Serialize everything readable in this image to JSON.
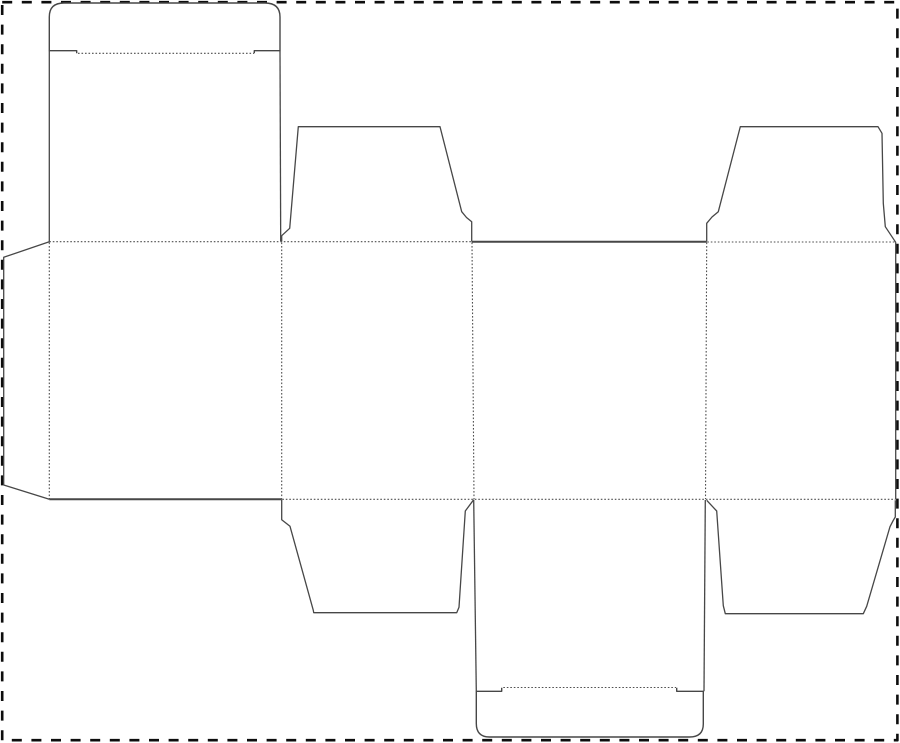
{
  "scene": {
    "width": 900,
    "height": 743,
    "background": "#ffffff",
    "description": "Die-cut folding box template (dieline) with solid cut lines and dotted fold lines inside a black dashed selection border"
  },
  "styles": {
    "cut_color": "#474747",
    "cut_width": 1.4,
    "fold_color": "#4f4f4f",
    "fold_width": 1.1,
    "fold_dash": "1.6 1.9",
    "border_color": "#0d0d0d",
    "border_width": 2.6,
    "border_dash": "10 9.6"
  },
  "border": {
    "x": 2.2,
    "y": 2.2,
    "width": 895.2,
    "height": 738
  },
  "dieline": {
    "cut_paths": [
      {
        "name": "top-tuck-flap-outline",
        "w": 1.4,
        "d": "M 76.7 53.3 L 76.7 50.7 L 49.3 50.7 L 49.3 17 Q 49.3 3 64 3 L 265 3 Q 280 3 280 17 L 280 50.7 L 254.3 50.7 L 254.3 53.3"
      },
      {
        "name": "top-panel-left-edge",
        "w": 1.3,
        "d": "M 49.3 50.7 L 49.3 241.7"
      },
      {
        "name": "top-panel-right-edge",
        "w": 1.3,
        "d": "M 280 50.7 L 280.7 241.2"
      },
      {
        "name": "top-left-flap-outline",
        "w": 1.3,
        "d": "M 281.7 241.5 L 281.7 235.7 L 289.7 228.3 L 298.3 126.7 L 440 126.7 L 461.7 211.7 L 466.5 217.5 L 471.7 221.7 L 471.7 241.5"
      },
      {
        "name": "top-center-cut-edge",
        "w": 2.0,
        "d": "M 471.7 241.7 L 706.7 241.7"
      },
      {
        "name": "top-right-flap-outline",
        "w": 1.3,
        "d": "M 706.7 241.5 L 706.7 223.3 L 712 217 L 718.3 211.7 L 740.3 126.7 L 878 126.7 L 882 133.3 L 883.3 203.3 L 885.3 226.7 L 895.7 242.3"
      },
      {
        "name": "right-body-cut-edge",
        "w": 1.3,
        "d": "M 895.7 242.3 L 895.7 499.5"
      },
      {
        "name": "left-dust-flap-outline",
        "w": 1.3,
        "d": "M 49.3 241.7 L 3.7 257.3 L 3.7 485 L 49.3 499.3"
      },
      {
        "name": "bottom-left-cut-edge",
        "w": 2.0,
        "d": "M 49.3 499.3 L 281.7 499.3"
      },
      {
        "name": "bottom-left-flap-outline",
        "w": 1.3,
        "d": "M 281.7 499.5 L 281.7 519.7 L 290 526.3 L 313.3 610.3 L 313.7 612.7 L 456.7 612.7 L 459 607.3 L 465.3 511 L 473.7 499.7"
      },
      {
        "name": "bottom-panel-left-edge",
        "w": 1.3,
        "d": "M 473.7 499.7 L 476.3 691.3"
      },
      {
        "name": "bottom-panel-right-edge",
        "w": 1.3,
        "d": "M 705.3 500 L 704 691.3"
      },
      {
        "name": "bottom-tuck-flap-outline",
        "w": 1.4,
        "d": "M 501.7 687.7 L 501.7 691.3 L 476.3 691.3 L 476.3 723.5 Q 476.3 737 489.5 737 L 689.5 737 Q 703.3 737 703.3 724 L 703.3 691.3 L 676.7 691.3 L 676.7 687.7"
      },
      {
        "name": "bottom-right-flap-outline",
        "w": 1.3,
        "d": "M 706.7 500.3 L 716.7 511 L 723.3 605.7 L 725.3 613.7 L 863.3 613.7 L 866.7 606.3 L 890 526.7 L 893.3 520.3 L 895.3 517 L 895.3 500.3"
      }
    ],
    "fold_lines": [
      {
        "name": "top-tuck-fold",
        "d": "M 78 53.3 L 254 53.3"
      },
      {
        "name": "top-fold-left",
        "d": "M 49.3 241.7 L 471 241.7"
      },
      {
        "name": "top-fold-right",
        "d": "M 707.3 242 L 895.3 242"
      },
      {
        "name": "bottom-fold",
        "d": "M 282.3 499.3 L 895.3 499.3"
      },
      {
        "name": "vertical-fold-dust-flap",
        "d": "M 49.3 242.5 L 49.3 498.8"
      },
      {
        "name": "vertical-fold-panel-1-2",
        "d": "M 281.7 242.5 L 281.7 498.8"
      },
      {
        "name": "vertical-fold-panel-2-3",
        "d": "M 472 242.5 L 474 499"
      },
      {
        "name": "vertical-fold-panel-3-4",
        "d": "M 706.7 242.5 L 705.5 499"
      },
      {
        "name": "bottom-tuck-fold",
        "d": "M 503.3 687.5 L 676 687.5"
      }
    ]
  }
}
